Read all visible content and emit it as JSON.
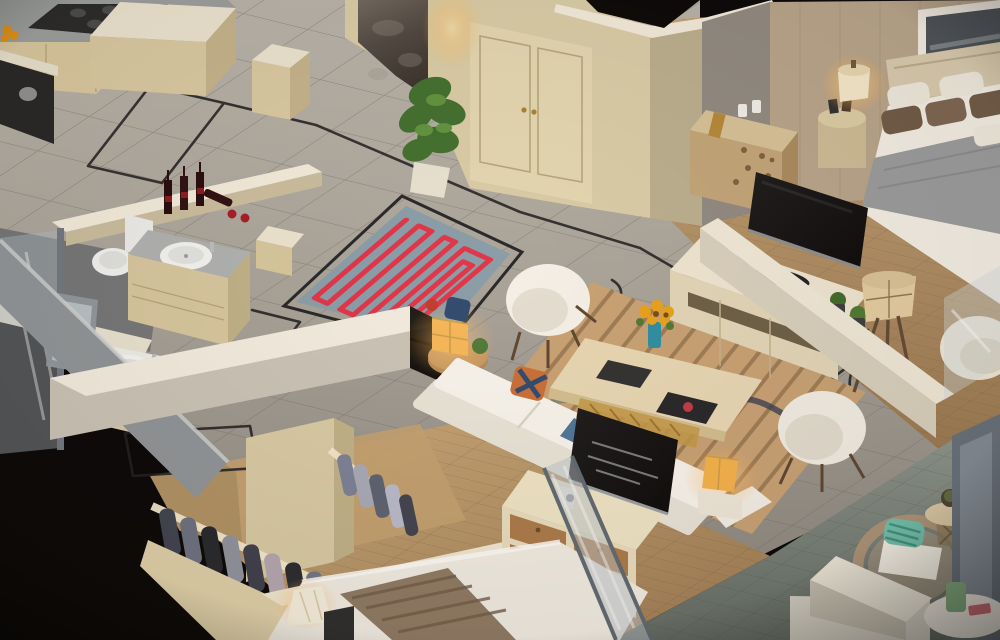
{
  "scene": {
    "title": "Isometric apartment cutaway render",
    "view": "3D isometric overhead cutaway, photorealistic interior visualization",
    "rooms": [
      {
        "id": "kitchen",
        "label": "Kitchen",
        "furniture": [
          "gas cooktop with burners",
          "gray marble countertops",
          "cream cabinet fronts",
          "built-in dark oven with kettle",
          "fruit bowl with oranges",
          "marble-top island",
          "cream pillar"
        ]
      },
      {
        "id": "dining",
        "label": "Dining area",
        "furniture": [
          "round black glass dining table",
          "six cream tub chairs",
          "five place settings with teal napkins",
          "small flower vase",
          "bar counter with wine bottles",
          "red wine glasses"
        ],
        "chair_count": 6,
        "wine_bottle_count": 4
      },
      {
        "id": "entry",
        "label": "Entry foyer",
        "furniture": [
          "cream double entry door with brass handles",
          "gray marble accent wall panel",
          "potted monstera plant in white planter",
          "warm wall sconce glow"
        ]
      },
      {
        "id": "bathroom-1",
        "label": "Bathroom 1",
        "furniture": [
          "white toilet",
          "marble-top vanity with oval sink",
          "cream vanity cabinet"
        ]
      },
      {
        "id": "bathroom-2",
        "label": "Bathroom 2",
        "furniture": [
          "white-top vanity with oval sink",
          "glass shower enclosure with gray frame",
          "leaning framed mirror"
        ]
      },
      {
        "id": "living-room",
        "label": "Living room",
        "furniture": [
          "white L-shaped sofa with navy and patterned pillows",
          "glowing amber cube lamp on round side table",
          "white shell armchair",
          "second cream armchair",
          "wood coffee table with sunflowers, notebook and magazine",
          "striped tan area rug with dark wave motif",
          "TV console with picture frames, decorative plate and succulents",
          "flat TV facing bedroom",
          "tripod floor lamp with drum shade",
          "glowing amber side lamp"
        ]
      },
      {
        "id": "master-bedroom",
        "label": "Master bedroom",
        "furniture": [
          "double bed with white duvet and gray blanket",
          "three brown and two white pillows",
          "cream headboard",
          "panoramic framed artwork",
          "round nightstand with lit lamp and photo frames",
          "perforated wood dresser with candles and book",
          "cream slipper chair"
        ]
      },
      {
        "id": "closet",
        "label": "Walk-in closet",
        "furniture": [
          "island wardrobe with lit rails",
          "hanging suits and shirts in grays, navy and lavender",
          "tall cream divider panel"
        ],
        "garment_count": 14
      },
      {
        "id": "bedroom-2",
        "label": "Second bedroom",
        "furniture": [
          "bed with white duvet and brown patterned runner",
          "dresser with wood drawer fronts and TV on top",
          "small white photo frame",
          "white flared table lamp",
          "leaning glass panel"
        ]
      },
      {
        "id": "balcony",
        "label": "Balcony",
        "furniture": [
          "green-gray stone tile floor",
          "rattan armchair with teal striped pillow and white cushion",
          "round wicker side table with succulent",
          "white corner parapet",
          "gray-blue glass post",
          "white round table with green pot"
        ]
      }
    ],
    "systems": {
      "floor_heating_mat": {
        "description": "blue-gray underlay mat with red serpentine heating coil, left serpentine section plus nested spiral section",
        "coil_color": "#e0334a",
        "mat_color": "#7b96a4"
      },
      "cable_runs": {
        "description": "dark conduit/cable lines routed across floors with rounded corners and an S-curve near the armchair",
        "color": "#1c1e22"
      }
    },
    "palette": {
      "void_black": "#060608",
      "marble_floor": "#aca9a2",
      "marble_grout": "#787672",
      "cream_wall": "#ddd2af",
      "white_cap": "#f3eee0",
      "accent_marble": "#57514e",
      "wood_floor": "#b3916a",
      "stone_floor": "#7d8882",
      "heating_coil": "#e0334a",
      "heating_mat": "#7b96a4",
      "sofa_white": "#f4f2ec",
      "rug_tan": "#c7a377",
      "rug_wave_navy": "#2e3a52",
      "blanket_gray": "#9a9da1",
      "pillow_brown": "#6d5a48",
      "lamp_glow": "#ffc97e",
      "tv_black": "#0e0f11",
      "wine_red": "#7a1020",
      "plant_green": "#4e7a35",
      "glass_blue": "#b9c6cf",
      "concrete_gray": "#8e959c"
    },
    "lights": [
      "entry sconce",
      "master nightstand lamp",
      "living cube lamp",
      "sofa-end amber lamp",
      "tripod floor lamp",
      "closet rail strips",
      "bedroom-2 table lamp"
    ]
  }
}
